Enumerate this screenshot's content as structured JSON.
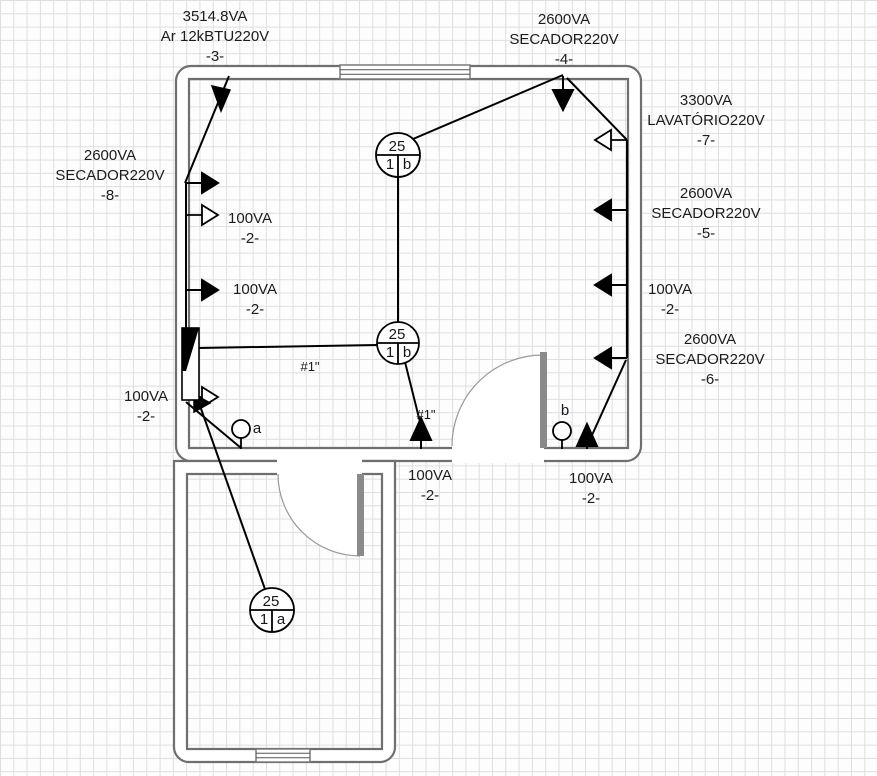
{
  "circuits": {
    "c3": {
      "va": "3514.8VA",
      "name": "Ar 12kBTU220V",
      "num": "-3-"
    },
    "c4": {
      "va": "2600VA",
      "name": "SECADOR220V",
      "num": "-4-"
    },
    "c7": {
      "va": "3300VA",
      "name": "LAVATÓRIO220V",
      "num": "-7-"
    },
    "c5": {
      "va": "2600VA",
      "name": "SECADOR220V",
      "num": "-5-"
    },
    "c6": {
      "va": "2600VA",
      "name": "SECADOR220V",
      "num": "-6-"
    },
    "c8": {
      "va": "2600VA",
      "name": "SECADOR220V",
      "num": "-8-"
    },
    "c2_right": {
      "va": "100VA",
      "num": "-2-"
    },
    "c2_left_1": {
      "va": "100VA",
      "num": "-2-"
    },
    "c2_left_2": {
      "va": "100VA",
      "num": "-2-"
    },
    "c2_left_3": {
      "va": "100VA",
      "num": "-2-"
    },
    "c2_bottom_1": {
      "va": "100VA",
      "num": "-2-"
    },
    "c2_bottom_2": {
      "va": "100VA",
      "num": "-2-"
    }
  },
  "lights": {
    "l1": {
      "top": "25",
      "bottom_left": "1",
      "bottom_right": "b"
    },
    "l2": {
      "top": "25",
      "bottom_left": "1",
      "bottom_right": "b"
    },
    "l3": {
      "top": "25",
      "bottom_left": "1",
      "bottom_right": "a"
    }
  },
  "switches": {
    "a": "a",
    "b": "b"
  },
  "wire_gauges": {
    "g1": "#1\"",
    "g2": "#1\""
  },
  "colors": {
    "wall": "#6f6f6f",
    "wire": "#000000",
    "door": "#8a8a8a"
  }
}
